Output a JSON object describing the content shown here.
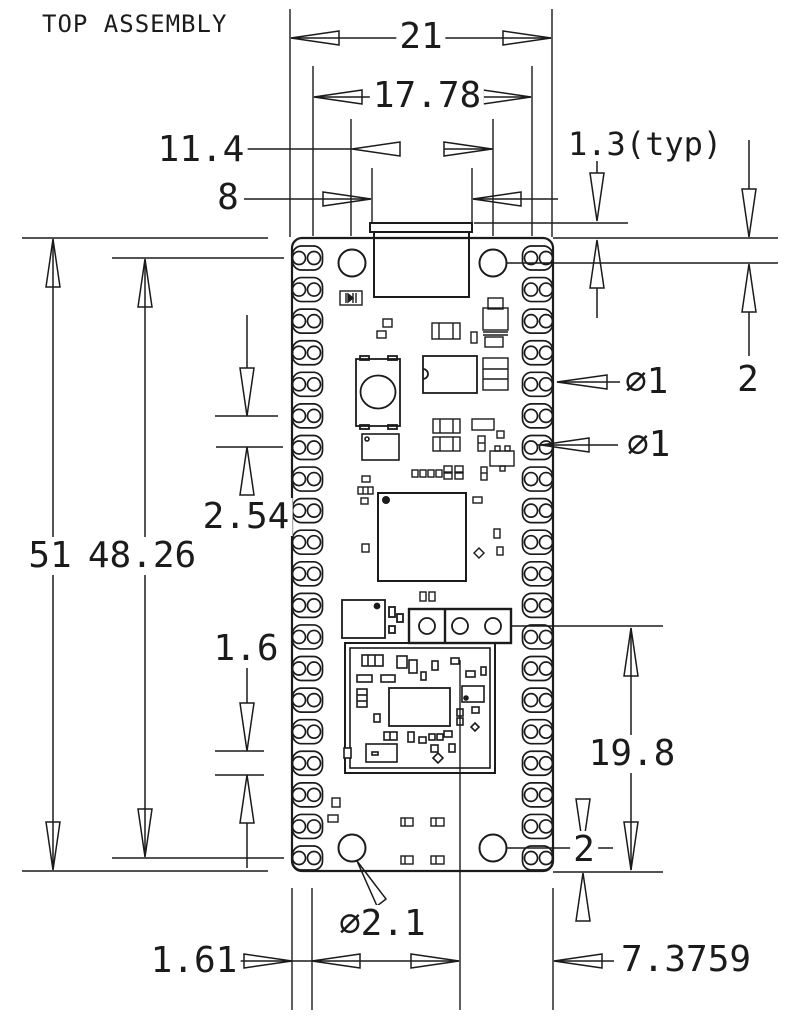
{
  "title": "TOP ASSEMBLY",
  "colors": {
    "ink": "#1b1b1b",
    "bg": "#ffffff"
  },
  "labels": {
    "board_width": "21",
    "pin_row_span": "17.78",
    "hole_spacing": "11.4",
    "usb_width": "8",
    "usb_overhang": "1.3(typ)",
    "edge_to_hole_top": "2",
    "castellation_dia": "∅1",
    "through_hole_dia": "∅1",
    "board_length": "51",
    "pad_span": "48.26",
    "pad_pitch": "2.54",
    "pad_width": "1.6",
    "header_from_bottom": "19.8",
    "edge_to_hole_bottom": "2",
    "edge_to_pin_row": "1.61",
    "mount_hole_dia": "∅2.1",
    "module_ref_to_edge": "7.3759"
  }
}
